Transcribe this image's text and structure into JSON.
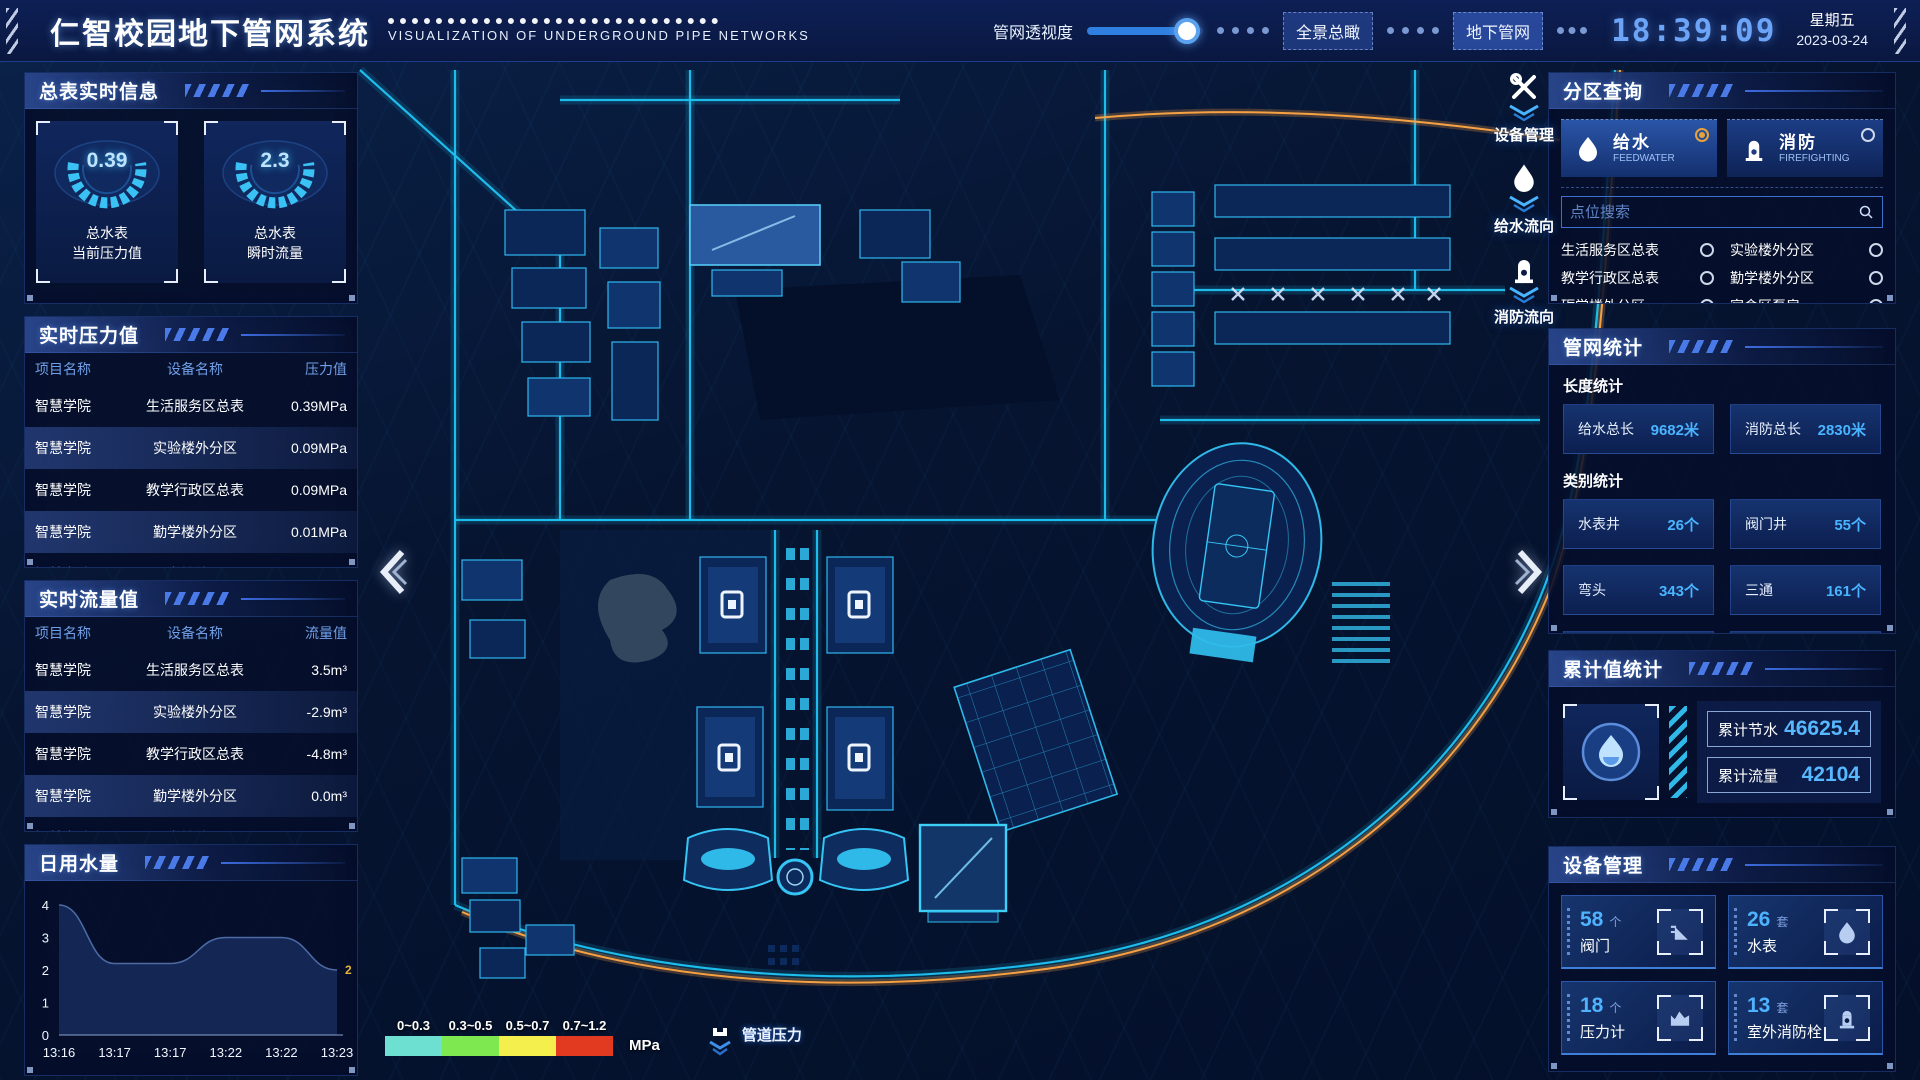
{
  "header": {
    "title": "仁智校园地下管网系统",
    "subtitle": "VISUALIZATION OF UNDERGROUND PIPE NETWORKS",
    "transparency_label": "管网透视度",
    "slider_pct": 86,
    "btn_overview": "全景总瞰",
    "btn_underground": "地下管网",
    "clock": "18:39:09",
    "weekday": "星期五",
    "date": "2023-03-24"
  },
  "left": {
    "meter_info": {
      "title": "总表实时信息",
      "gauges": [
        {
          "value": "0.39",
          "line1": "总水表",
          "line2": "当前压力值"
        },
        {
          "value": "2.3",
          "line1": "总水表",
          "line2": "瞬时流量"
        }
      ]
    },
    "pressure": {
      "title": "实时压力值",
      "headers": [
        "项目名称",
        "设备名称",
        "压力值"
      ],
      "rows": [
        [
          "智慧学院",
          "生活服务区总表",
          "0.39MPa"
        ],
        [
          "智慧学院",
          "实验楼外分区",
          "0.09MPa"
        ],
        [
          "智慧学院",
          "教学行政区总表",
          "0.09MPa"
        ],
        [
          "智慧学院",
          "勤学楼外分区",
          "0.01MPa"
        ],
        [
          "智慧学院",
          "砺学楼外分区",
          "0.00MPa"
        ]
      ]
    },
    "flow": {
      "title": "实时流量值",
      "headers": [
        "项目名称",
        "设备名称",
        "流量值"
      ],
      "rows": [
        [
          "智慧学院",
          "生活服务区总表",
          "3.5m³"
        ],
        [
          "智慧学院",
          "实验楼外分区",
          "-2.9m³"
        ],
        [
          "智慧学院",
          "教学行政区总表",
          "-4.8m³"
        ],
        [
          "智慧学院",
          "勤学楼外分区",
          "0.0m³"
        ],
        [
          "智慧学院",
          "砺学楼外分区",
          "2.3m³"
        ]
      ]
    },
    "daily": {
      "title": "日用水量",
      "chart_data": {
        "type": "area",
        "x": [
          "13:16",
          "13:17",
          "13:17",
          "13:22",
          "13:22",
          "13:23"
        ],
        "values": [
          4,
          2.2,
          2.2,
          3,
          3,
          2
        ],
        "yticks": [
          0,
          1,
          2,
          3,
          4
        ],
        "ylim": [
          0,
          4
        ],
        "end_label": "2",
        "title": "日用水量"
      }
    }
  },
  "map": {
    "toolbar": [
      {
        "label": "设备管理"
      },
      {
        "label": "给水流向"
      },
      {
        "label": "消防流向"
      }
    ],
    "legend": {
      "ranges": [
        {
          "label": "0~0.3",
          "color": "#6ee0d2"
        },
        {
          "label": "0.3~0.5",
          "color": "#7de84f"
        },
        {
          "label": "0.5~0.7",
          "color": "#f5ef4e"
        },
        {
          "label": "0.7~1.2",
          "color": "#e23a20"
        }
      ],
      "unit": "MPa",
      "pressure_label": "管道压力"
    }
  },
  "right": {
    "zone_query": {
      "title": "分区查询",
      "toggles": [
        {
          "label": "给水",
          "sub": "FEEDWATER",
          "selected": true
        },
        {
          "label": "消防",
          "sub": "FIREFIGHTING",
          "selected": false
        }
      ],
      "search_placeholder": "点位搜索",
      "options": [
        "生活服务区总表",
        "实验楼外分区",
        "教学行政区总表",
        "勤学楼外分区",
        "砺学楼外分区",
        "宿舍区泵房"
      ]
    },
    "pipe_stats": {
      "title": "管网统计",
      "length_title": "长度统计",
      "length_items": [
        {
          "label": "给水总长",
          "value": "9682米"
        },
        {
          "label": "消防总长",
          "value": "2830米"
        }
      ],
      "category_title": "类别统计",
      "category_items": [
        {
          "label": "水表井",
          "value": "26个"
        },
        {
          "label": "阀门井",
          "value": "55个"
        },
        {
          "label": "弯头",
          "value": "343个"
        },
        {
          "label": "三通",
          "value": "161个"
        }
      ]
    },
    "cumulative": {
      "title": "累计值统计",
      "items": [
        {
          "label": "累计节水",
          "value": "46625.4"
        },
        {
          "label": "累计流量",
          "value": "42104"
        }
      ]
    },
    "devices": {
      "title": "设备管理",
      "cards": [
        {
          "count": "58",
          "unit": "个",
          "label": "阀门"
        },
        {
          "count": "26",
          "unit": "套",
          "label": "水表"
        },
        {
          "count": "18",
          "unit": "个",
          "label": "压力计"
        },
        {
          "count": "13",
          "unit": "套",
          "label": "室外消防栓"
        }
      ]
    }
  }
}
